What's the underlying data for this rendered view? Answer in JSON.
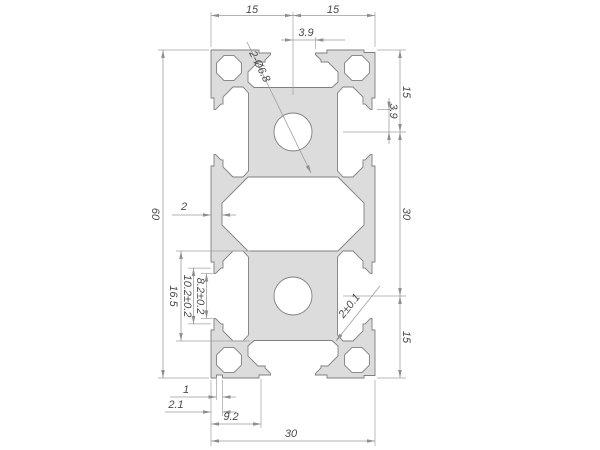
{
  "drawing": {
    "title": "aluminium-extrusion-profile-30x60-cross-section",
    "colors": {
      "background": "#ffffff",
      "profile_fill": "#dcdcdc",
      "profile_stroke": "#7f7f7f",
      "dimension_lines": "#9a9a9a",
      "dimension_text": "#4a4a4a"
    },
    "dims": {
      "top_left_15": "15",
      "top_right_15": "15",
      "top_3_9": "3.9",
      "holes_callout": "2-Ø6.8",
      "right_3_9": "3.9",
      "right_top_15": "15",
      "right_30": "30",
      "right_bottom_15": "15",
      "left_60": "60",
      "wall_2": "2",
      "slot_16_5": "16.5",
      "slot_10_2": "10.2±0.2",
      "slot_8_2": "8.2±0.2",
      "web_2_tol": "2±0.1",
      "bottom_1": "1",
      "bottom_2_1": "2.1",
      "bottom_9_2": "9.2",
      "bottom_30": "30"
    }
  }
}
